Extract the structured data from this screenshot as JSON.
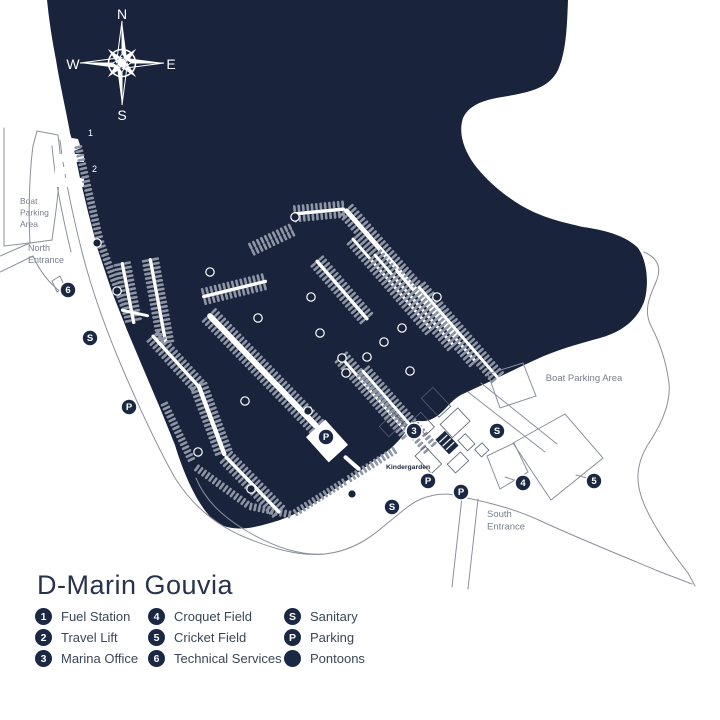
{
  "title": "D-Marin Gouvia",
  "colors": {
    "water": "#19233C",
    "land": "#ffffff",
    "comb": "#8E96A6",
    "outline": "#8B909B",
    "building_outline": "#555E6E",
    "badge_fill": "#1B2844",
    "badge_text": "#ffffff",
    "label_gray": "#787F8B",
    "label_navy": "#1B2742",
    "legend_text": "#3B4656"
  },
  "compass": {
    "north": "N",
    "east": "E",
    "south": "S",
    "west": "W"
  },
  "map_labels": [
    {
      "id": "boat-parking-area-left",
      "lines": [
        "Boat",
        "Parking",
        "Area"
      ],
      "x": 20,
      "y": 204,
      "size": 8.5,
      "color": "gray",
      "anchor": "start"
    },
    {
      "id": "north-entrance",
      "lines": [
        "North",
        "Entrance"
      ],
      "x": 28,
      "y": 251,
      "size": 9,
      "color": "gray",
      "anchor": "start"
    },
    {
      "id": "boat-parking-area-right",
      "lines": [
        "Boat Parking Area"
      ],
      "x": 584,
      "y": 381,
      "size": 9.5,
      "color": "gray",
      "anchor": "middle"
    },
    {
      "id": "south-entrance",
      "lines": [
        "South",
        "Entrance"
      ],
      "x": 487,
      "y": 517,
      "size": 9.5,
      "color": "gray",
      "anchor": "start"
    },
    {
      "id": "kindergarden",
      "lines": [
        "Kindergarden"
      ],
      "x": 386,
      "y": 469,
      "size": 6.8,
      "color": "navy",
      "anchor": "start",
      "bold": true
    },
    {
      "id": "fuel-station-number",
      "lines": [
        "1"
      ],
      "x": 88,
      "y": 136,
      "size": 9,
      "color": "white",
      "anchor": "start"
    },
    {
      "id": "travel-lift-number",
      "lines": [
        "2"
      ],
      "x": 92,
      "y": 172,
      "size": 9,
      "color": "white",
      "anchor": "start"
    }
  ],
  "badges": [
    {
      "label": "6",
      "x": 68,
      "y": 290
    },
    {
      "label": "S",
      "x": 90,
      "y": 338
    },
    {
      "label": "P",
      "x": 129,
      "y": 407
    },
    {
      "label": "P",
      "x": 326,
      "y": 437
    },
    {
      "label": "3",
      "x": 414,
      "y": 431
    },
    {
      "label": "S",
      "x": 497,
      "y": 431
    },
    {
      "label": "P",
      "x": 428,
      "y": 481
    },
    {
      "label": "P",
      "x": 461,
      "y": 492
    },
    {
      "label": "S",
      "x": 392,
      "y": 507
    },
    {
      "label": "4",
      "x": 523,
      "y": 483
    },
    {
      "label": "5",
      "x": 594,
      "y": 481
    }
  ],
  "pontoon_markers": [
    {
      "x": 97,
      "y": 243
    },
    {
      "x": 117,
      "y": 291
    },
    {
      "x": 210,
      "y": 272
    },
    {
      "x": 295,
      "y": 217
    },
    {
      "x": 258,
      "y": 318
    },
    {
      "x": 311,
      "y": 297
    },
    {
      "x": 320,
      "y": 333
    },
    {
      "x": 342,
      "y": 358
    },
    {
      "x": 367,
      "y": 357
    },
    {
      "x": 384,
      "y": 342
    },
    {
      "x": 402,
      "y": 328
    },
    {
      "x": 410,
      "y": 371
    },
    {
      "x": 346,
      "y": 373
    },
    {
      "x": 245,
      "y": 401
    },
    {
      "x": 308,
      "y": 411
    },
    {
      "x": 198,
      "y": 452
    },
    {
      "x": 251,
      "y": 489
    },
    {
      "x": 352,
      "y": 494
    },
    {
      "x": 437,
      "y": 297
    }
  ],
  "legend": {
    "columns": [
      {
        "items": [
          {
            "badge": "1",
            "label": "Fuel Station"
          },
          {
            "badge": "2",
            "label": "Travel Lift"
          },
          {
            "badge": "3",
            "label": "Marina Office"
          }
        ]
      },
      {
        "items": [
          {
            "badge": "4",
            "label": "Croquet Field"
          },
          {
            "badge": "5",
            "label": "Cricket Field"
          },
          {
            "badge": "6",
            "label": "Technical Services"
          }
        ]
      },
      {
        "items": [
          {
            "badge": "S",
            "label": "Sanitary"
          },
          {
            "badge": "P",
            "label": "Parking"
          },
          {
            "badge": "",
            "label": "Pontoons"
          }
        ]
      }
    ]
  }
}
